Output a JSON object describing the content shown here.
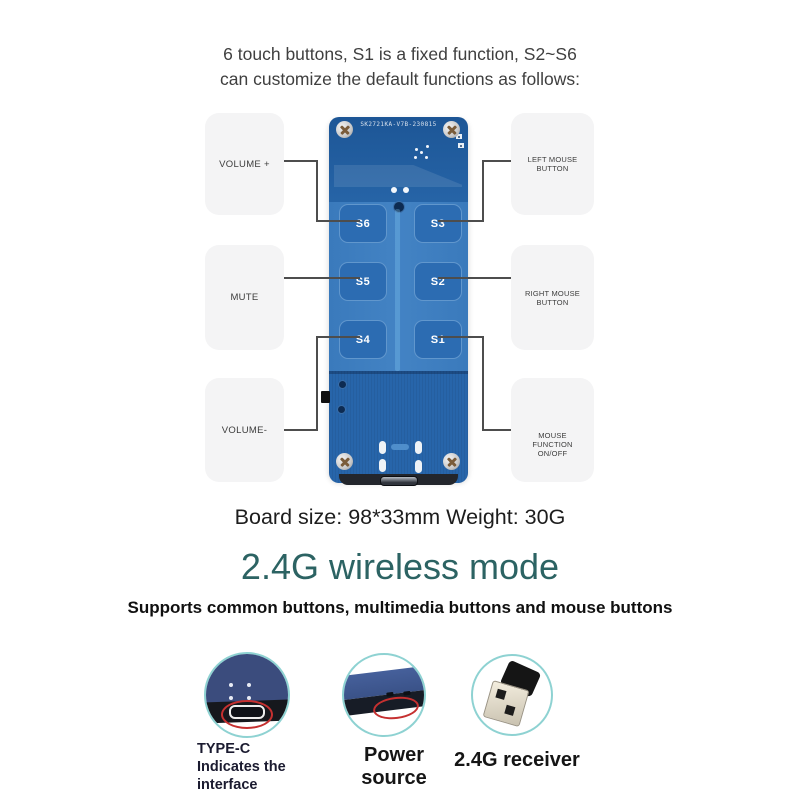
{
  "intro": {
    "line1": "6 touch buttons, S1 is a fixed function, S2~S6",
    "line2": "can customize the default functions as follows:"
  },
  "board": {
    "silkscreen": "SK2721KA-V7B-230815",
    "buttons": [
      "S6",
      "S3",
      "S5",
      "S2",
      "S4",
      "S1"
    ]
  },
  "callouts": {
    "left": [
      "VOLUME +",
      "MUTE",
      "VOLUME-"
    ],
    "right": [
      "LEFT MOUSE BUTTON",
      "RIGHT MOUSE BUTTON",
      "MOUSE FUNCTION ON/OFF"
    ]
  },
  "specs": {
    "line": "Board size: 98*33mm Weight: 30G"
  },
  "wireless": {
    "title": "2.4G wireless mode",
    "subtitle": "Supports common buttons, multimedia buttons and mouse buttons"
  },
  "features": [
    {
      "label": "TYPE-C Indicates the interface",
      "icon": "type-c-port-photo-icon"
    },
    {
      "label": "Power source",
      "icon": "board-edge-photo-icon"
    },
    {
      "label": "2.4G receiver",
      "icon": "usb-dongle-photo-icon"
    }
  ],
  "colors": {
    "accent_teal": "#2c6363",
    "ring_teal": "#8ed2d2",
    "pcb_dark": "#205a9b",
    "pcb_mid": "#4080c0",
    "pad_blue": "#2c6cb2",
    "annotation_red": "#c53030",
    "line_gray": "#4d4d4d",
    "callout_bg": "#f4f4f5"
  }
}
